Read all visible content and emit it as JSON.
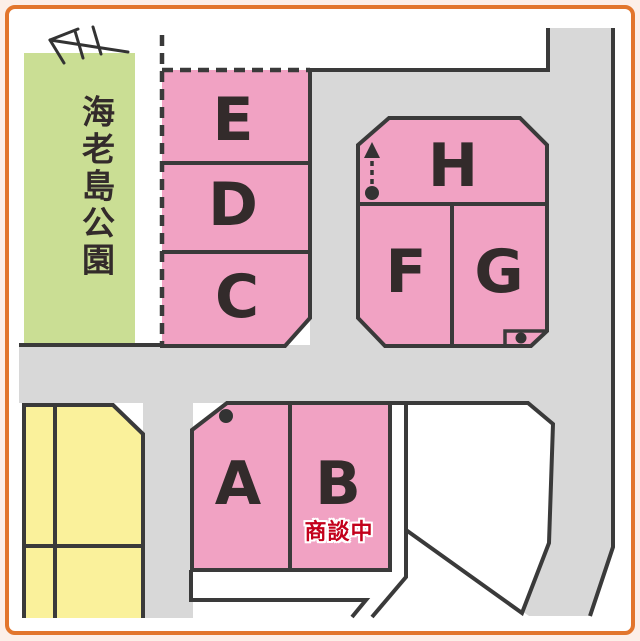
{
  "map": {
    "park": {
      "label": "海老島公園"
    },
    "lots": [
      {
        "id": "E",
        "label": "E"
      },
      {
        "id": "D",
        "label": "D"
      },
      {
        "id": "C",
        "label": "C"
      },
      {
        "id": "H",
        "label": "H"
      },
      {
        "id": "F",
        "label": "F"
      },
      {
        "id": "G",
        "label": "G"
      },
      {
        "id": "A",
        "label": "A"
      },
      {
        "id": "B",
        "label": "B"
      }
    ],
    "status": {
      "label": "商談中"
    },
    "colors": {
      "lot_pink": "#F1A2C3",
      "park_green": "#CADE94",
      "other_block_yellow": "#FAF19B",
      "road_gray": "#D8D8D8",
      "line_dark": "#3A3A3A",
      "frame_orange": "#E2762D",
      "status_red": "#C3001B"
    }
  }
}
